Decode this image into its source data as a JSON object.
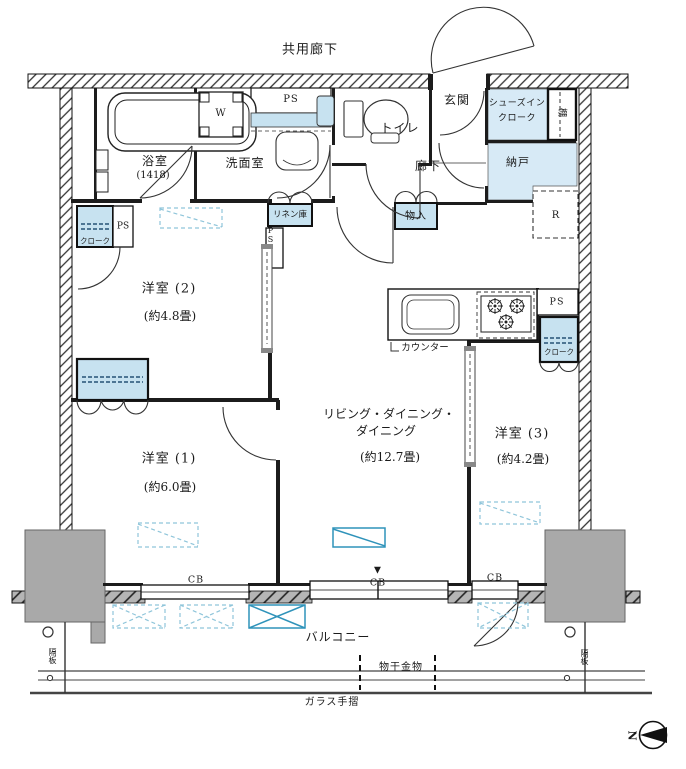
{
  "colors": {
    "closet_blue": "#c7e2f0",
    "room_blue": "#d7eaf6",
    "accent_blue": "#2f93ba",
    "dashed_blue": "#8fc5da",
    "pillar_gray": "#a9a9a9",
    "wall_black": "#1c1c1c"
  },
  "areas": {
    "common_corridor": "共用廊下",
    "bathroom": {
      "name": "浴室",
      "size": "(1418)"
    },
    "washroom": "洗面室",
    "toilet": "トイレ",
    "entrance": "玄関",
    "shoe_closet_line1": "シューズイン",
    "shoe_closet_line2": "クローク",
    "shelf": "棚",
    "storeroom": "納戸",
    "hallway": "廊下",
    "storage_box": "物入",
    "linen_closet": "リネン庫",
    "western_room_2": {
      "name": "洋室 (2)",
      "size": "(約4.8畳)"
    },
    "western_room_1": {
      "name": "洋室 (1)",
      "size": "(約6.0畳)"
    },
    "western_room_3": {
      "name": "洋室 (3)",
      "size": "(約4.2畳)"
    },
    "living_dining_line1": "リビング・ダイニング・",
    "living_dining_line2": "ダイニング",
    "living_dining_size": "(約12.7畳)",
    "balcony": "バルコニー",
    "counter": "カウンター",
    "laundry_fitting": "物干金物",
    "glass_handrail": "ガラス手摺",
    "partition_board": "隔板"
  },
  "marks": {
    "ps": "PS",
    "washer": "W",
    "refrigerator": "R",
    "cb": "CB",
    "closet": "クローク",
    "north": "N",
    "triangle": "▼"
  }
}
